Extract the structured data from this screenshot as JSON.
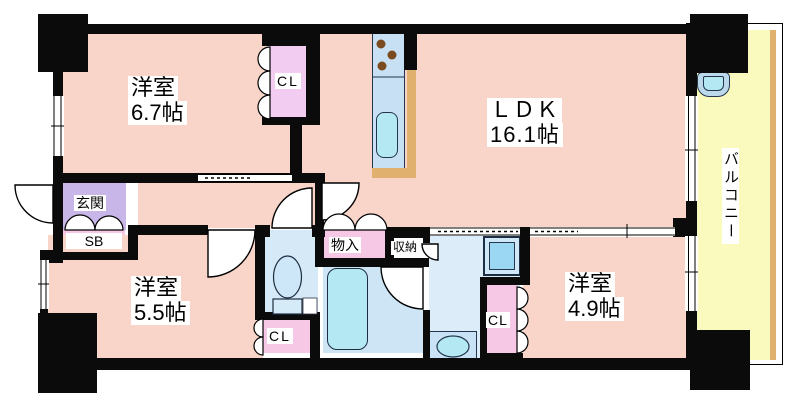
{
  "plan": {
    "type": "apartment-floor-plan",
    "rooms": {
      "ldk": {
        "name": "ＬＤＫ",
        "size": "16.1帖"
      },
      "western1": {
        "name": "洋室",
        "size": "6.7帖"
      },
      "western2": {
        "name": "洋室",
        "size": "5.5帖"
      },
      "western3": {
        "name": "洋室",
        "size": "4.9帖"
      },
      "balcony": {
        "name": "バルコニー"
      },
      "entrance": {
        "name": "玄関"
      },
      "shoe_box": {
        "name": "SB"
      },
      "closet_top": {
        "name": "CL"
      },
      "closet_west2": {
        "name": "CL"
      },
      "closet_west3": {
        "name": "CL"
      },
      "storage_hall": {
        "name": "物入"
      },
      "storage_wash": {
        "name": "収納"
      }
    },
    "colors": {
      "room_floor": "#f8d5c8",
      "entrance_floor": "#c9b6e8",
      "closet_pink": "#f6c8e6",
      "closet_lavender": "#f2cdf1",
      "wet_floor": "#d5e9f7",
      "bath_floor": "#cde5f4",
      "washroom_floor": "#dcedf9",
      "balcony_floor": "#fafabe",
      "counter_blue": "#c8e0f4",
      "fixture_cyan": "#b4e9f4",
      "counter_edge_tan": "#e0b06e",
      "washer_blue": "#9bd6f2",
      "wall": "#0b0b0b",
      "burner_brown": "#7b4a1f"
    }
  }
}
